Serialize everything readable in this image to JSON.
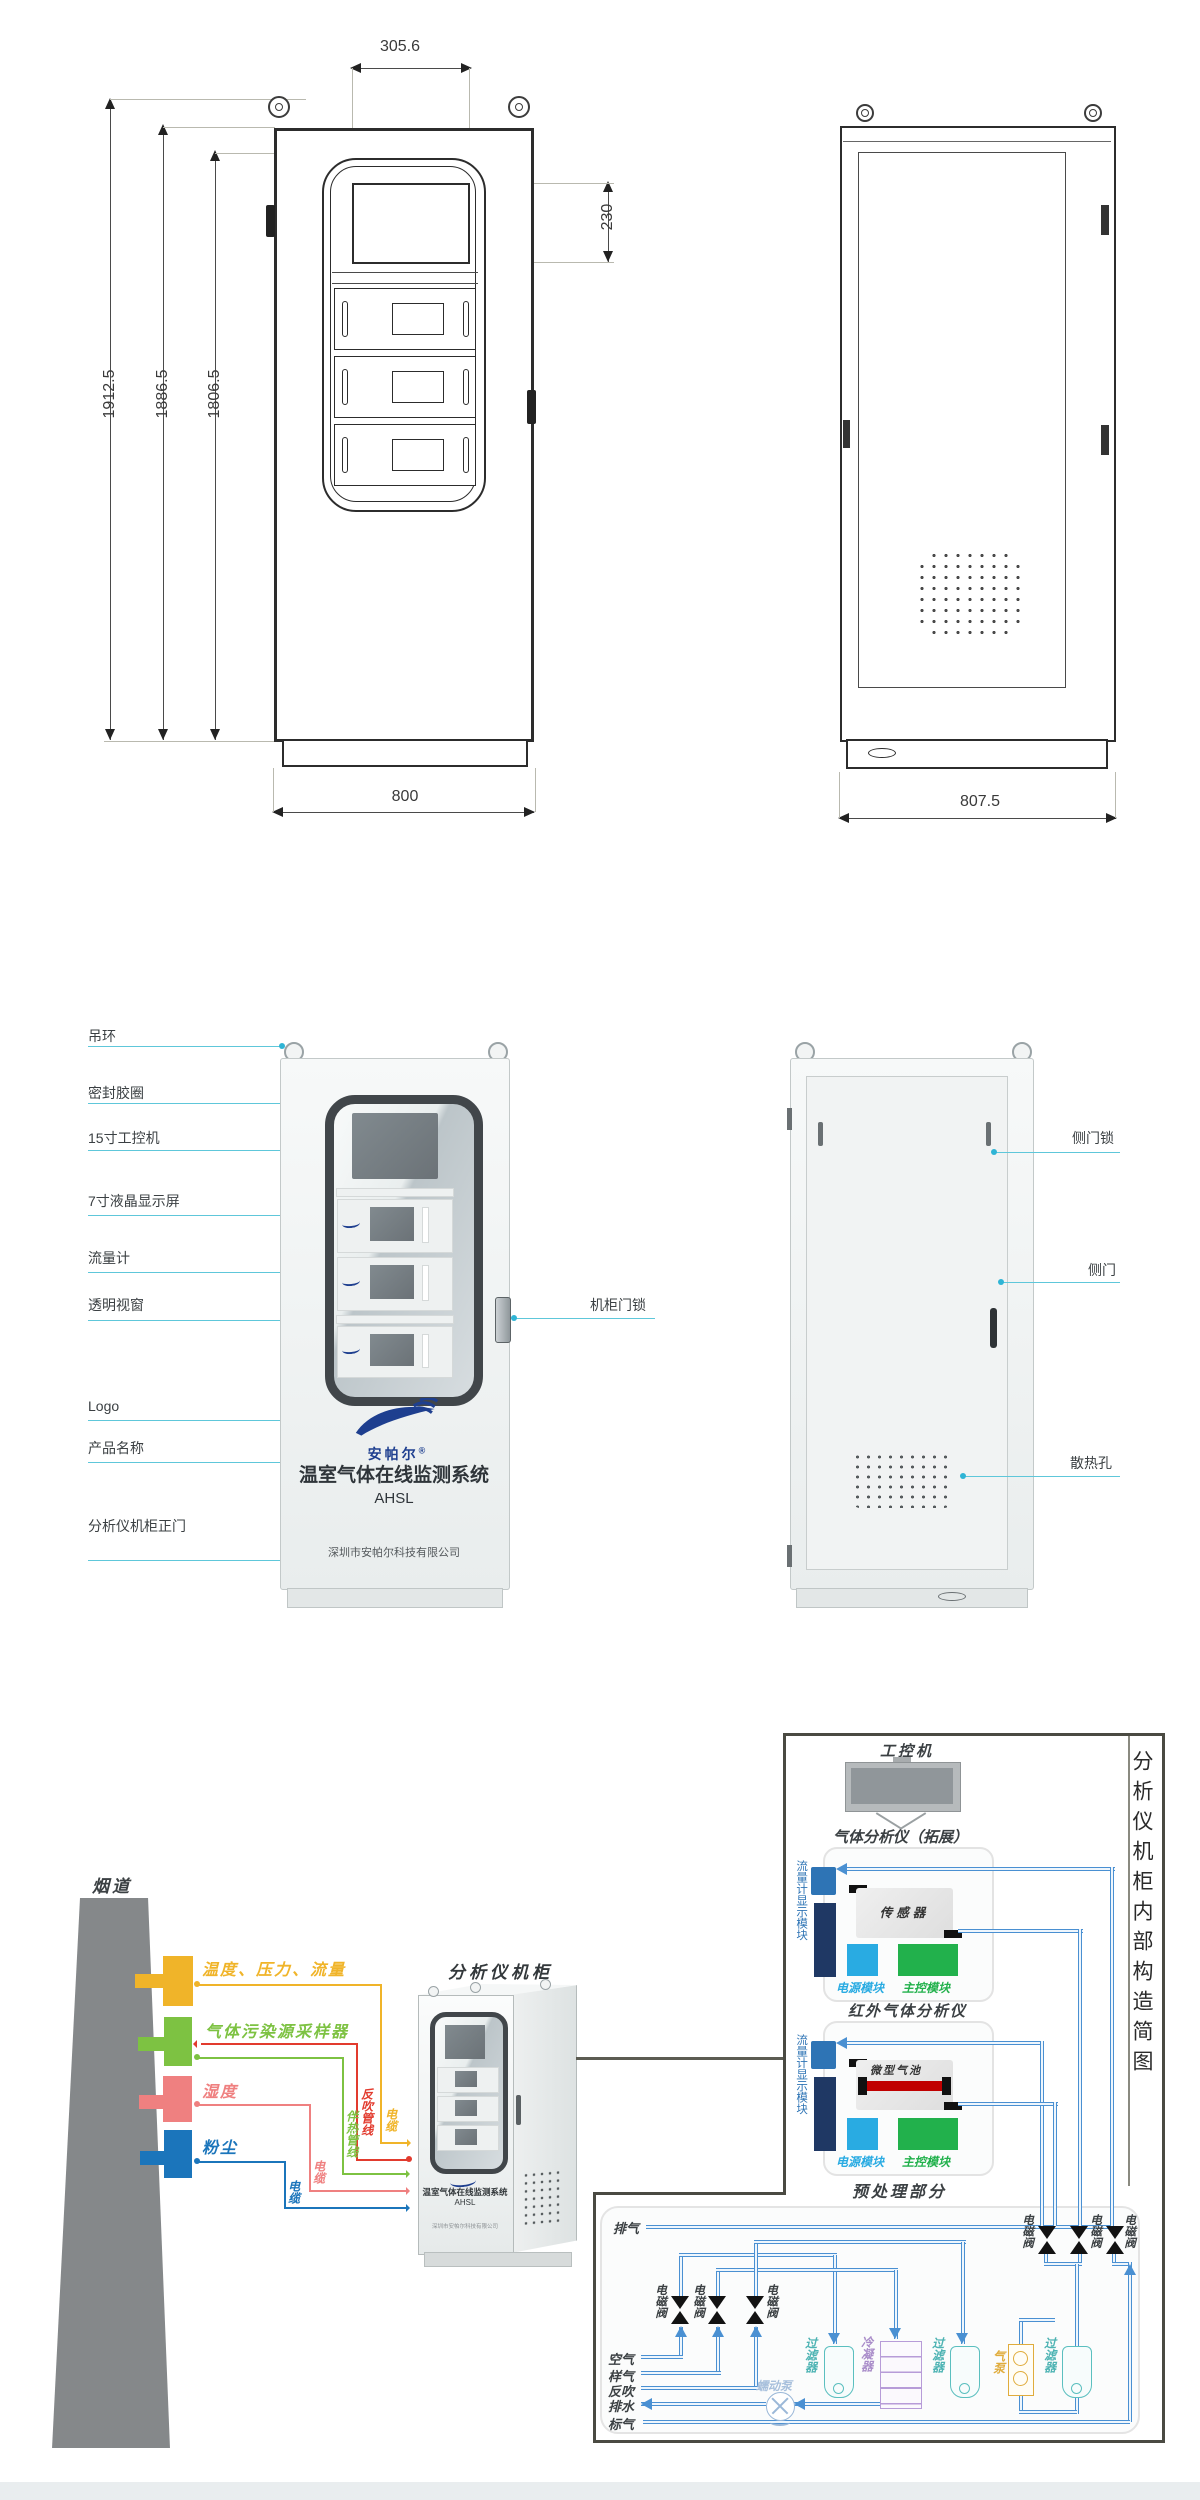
{
  "top": {
    "dim_total_height": "1912.5",
    "dim_body_height": "1886.5",
    "dim_door_height": "1806.5",
    "dim_top_width": "305.6",
    "dim_screen_height": "230",
    "dim_front_width": "800",
    "dim_side_depth": "807.5"
  },
  "middle": {
    "labels_left": [
      "吊环",
      "密封胶圈",
      "15寸工控机",
      "7寸液晶显示屏",
      "流量计",
      "透明视窗",
      "Logo",
      "产品名称",
      "分析仪机柜正门"
    ],
    "label_cabinet_lock": "机柜门锁",
    "labels_right": [
      "侧门锁",
      "侧门",
      "散热孔"
    ],
    "brand": "安帕尔",
    "brand_reg": "®",
    "product_name": "温室气体在线监测系统",
    "model": "AHSL",
    "company": "深圳市安帕尔科技有限公司"
  },
  "bottom": {
    "flue": "烟道",
    "sensors": [
      "温度、压力、流量",
      "气体污染源采样器",
      "湿度",
      "粉尘"
    ],
    "cable": "电缆",
    "heat_trace": "伴热管线",
    "blowback": "反吹管线",
    "cabinet_title": "分析仪机柜",
    "panel_title": "分析仪机柜内部构造简图",
    "ipc": "工控机",
    "analyzer_ext_title": "气体分析仪（拓展）",
    "analyzer_ir_title": "红外气体分析仪",
    "flow_display": "流量计显示模块",
    "sensor_box": "传感器",
    "gas_cell": "微型气池",
    "power_module": "电源模块",
    "main_module": "主控模块",
    "pretreat_title": "预处理部分",
    "exhaust": "排气",
    "valve": "电磁阀",
    "filter": "过滤器",
    "condenser": "冷凝器",
    "air_pump": "气泵",
    "pump": "蠕动泵",
    "lines": [
      "空气",
      "样气",
      "反吹",
      "排水",
      "标气"
    ]
  },
  "colors": {
    "pipe_blue": "#4a90d2",
    "callout_cyan": "#45bcd7",
    "sensor_yellow": "#f0b429",
    "sensor_green": "#7dc242",
    "sensor_pink": "#ef8080",
    "sensor_blue": "#1b75bb",
    "blowback_red": "#e23b2e",
    "power_blue": "#29abe2",
    "main_green": "#22b14c",
    "navy": "#1f3864",
    "flow_blue": "#2e74b5",
    "brand_blue": "#1e3f8f"
  }
}
